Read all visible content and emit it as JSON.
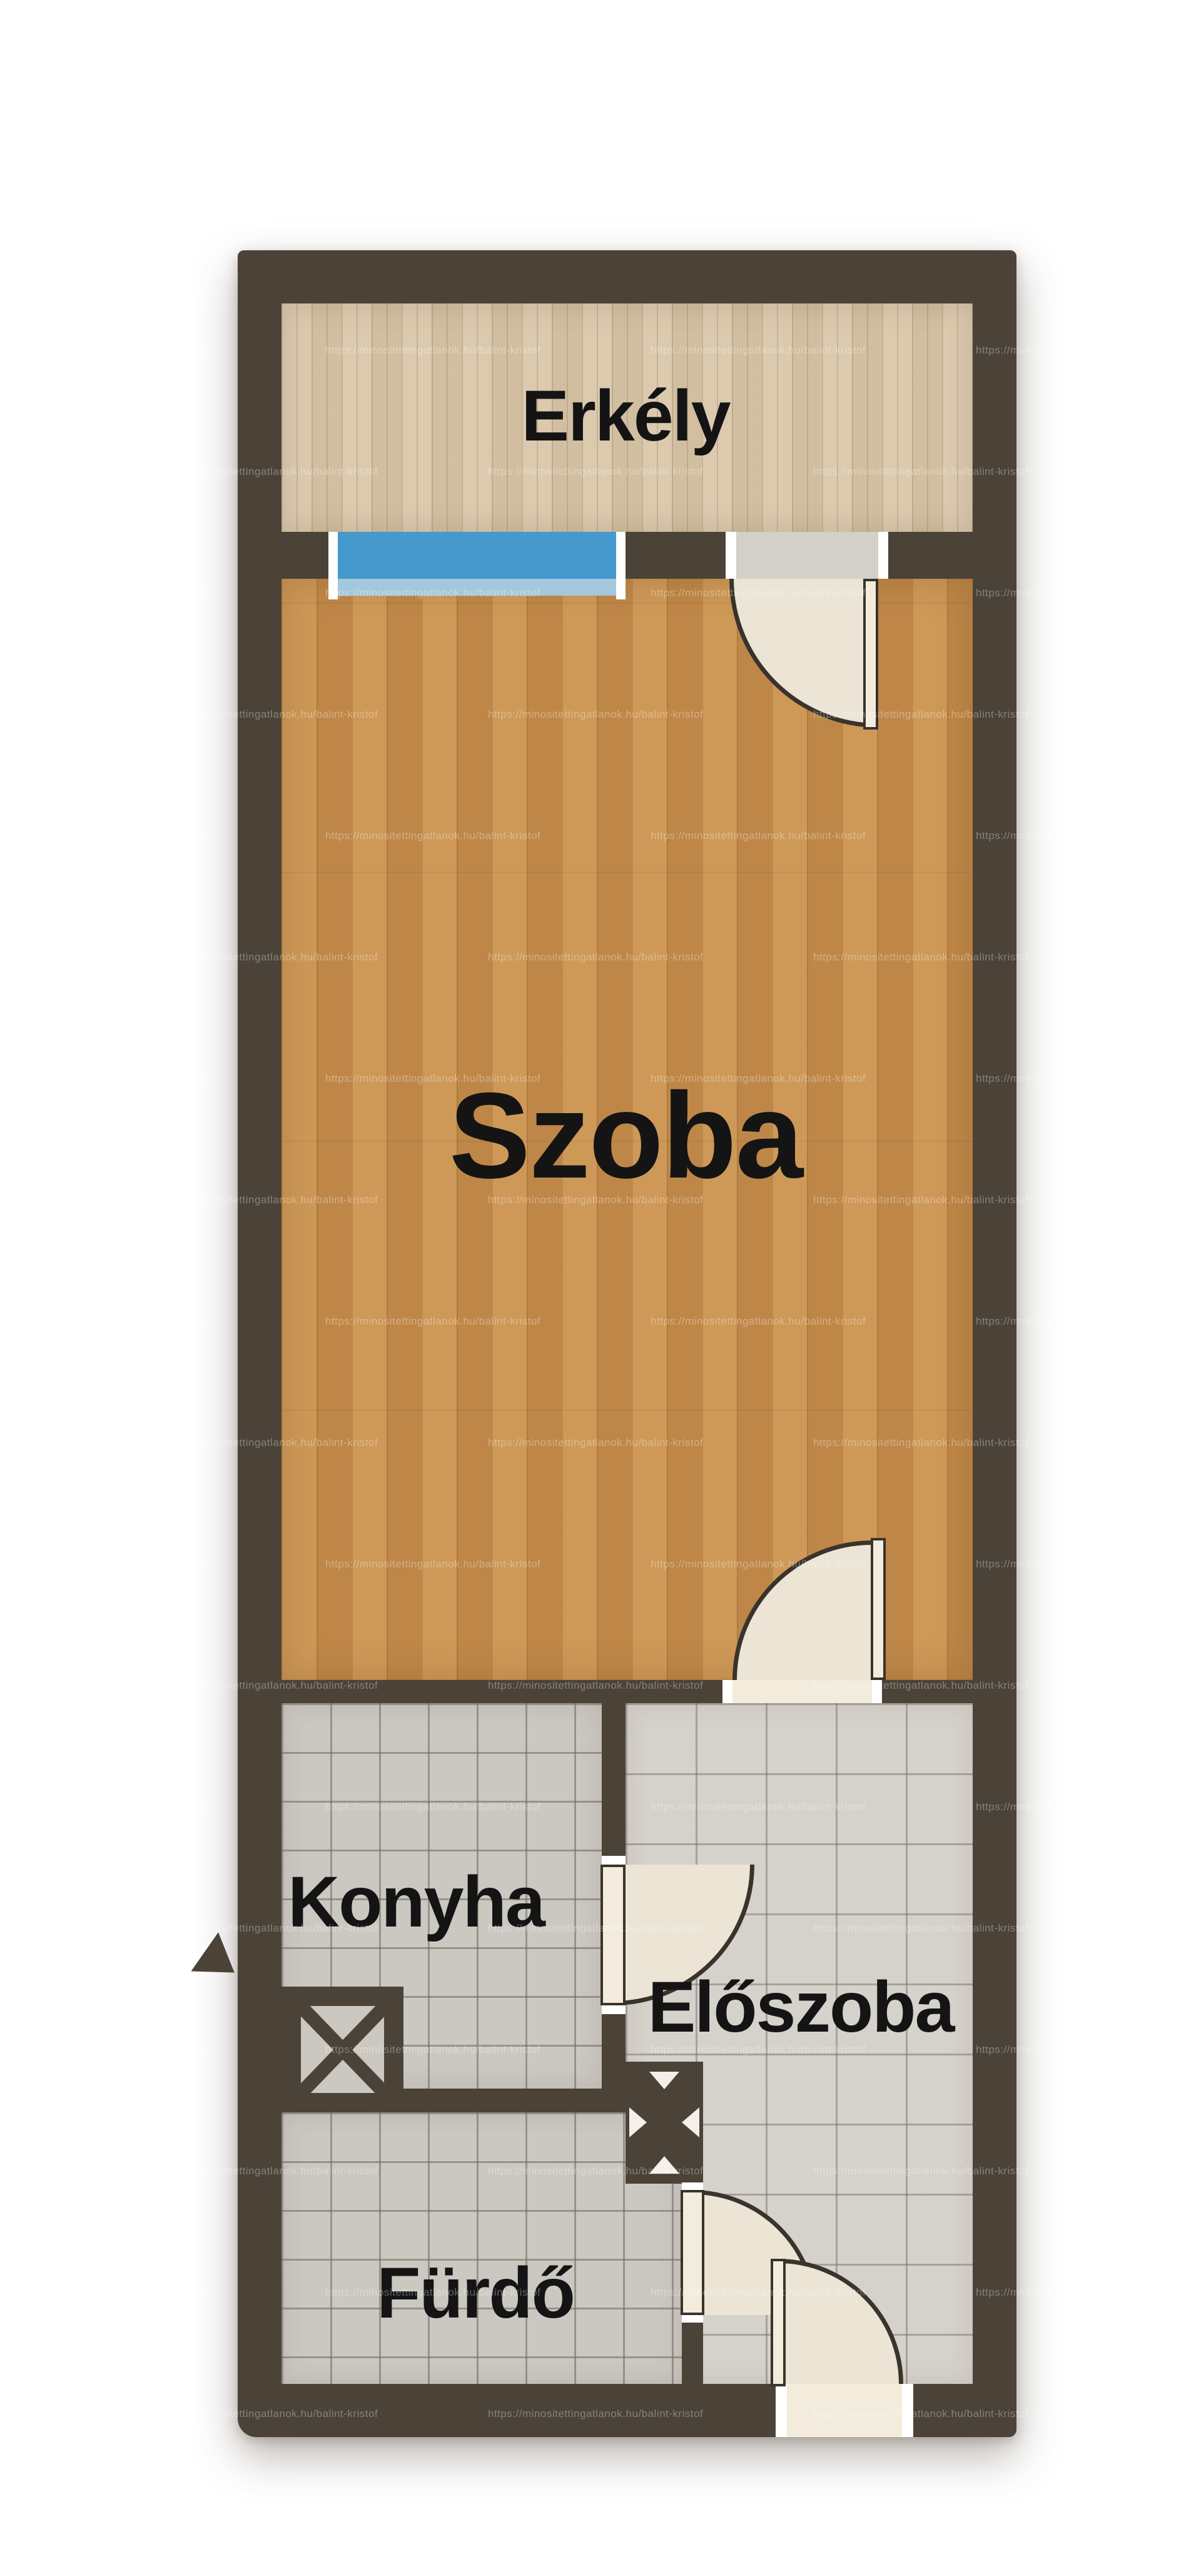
{
  "plan": {
    "watermark_text": "https://minositettingatlanok.hu/balint-kristof",
    "rooms": {
      "balcony": {
        "label": "Erkély"
      },
      "room": {
        "label": "Szoba"
      },
      "kitchen": {
        "label": "Konyha"
      },
      "hall": {
        "label": "Előszoba"
      },
      "bathroom": {
        "label": "Fürdő"
      }
    },
    "colors": {
      "wall": "#4b4238",
      "balcony_floor": "#d9c6a8",
      "room_floor": "#c8904e",
      "tile_small": "#cbc7c1",
      "tile_large": "#d5d1cb",
      "window_glass": "#4599cd",
      "window_sill": "#a3c8de",
      "door_leaf": "#f3ecdc",
      "door_swing": "#ece4d4",
      "arc_line": "#3a332c",
      "label_text": "#141414"
    },
    "watermark_layout": {
      "row_step": 194,
      "col_step": 520,
      "row_start": 162,
      "odd_row_shift": -260
    }
  }
}
